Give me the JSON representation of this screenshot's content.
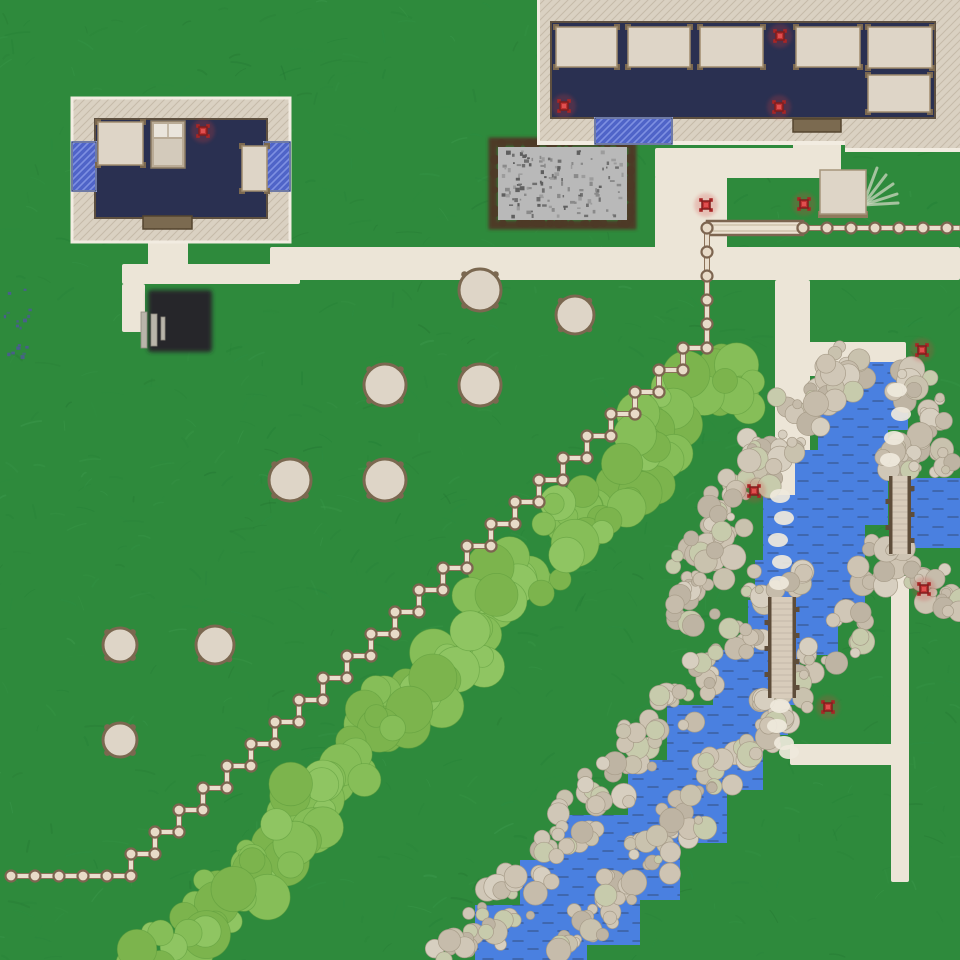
{
  "meta": {
    "width": 960,
    "height": 960
  },
  "palette": {
    "grass_base": "#2e8a3c",
    "grass_strokes": [
      "#27813a",
      "#3a9a4c",
      "#1e7a33",
      "#45a357",
      "#2a8f44",
      "#216f2f"
    ],
    "path_fill": "#ece5d7",
    "water_fill": "#4a80e0",
    "water_wave": "#3b5f9f",
    "wall_base": "#dad1c2",
    "wall_hatch_line": "#c6bba9",
    "wall_edge_light": "#f2ece1",
    "wall_border_dark": "#5e5040",
    "floor_navy": "#2a3051",
    "window_base": "#4f64c8",
    "window_stripe": "#7e90e2",
    "window_edge": "#b9c4ef",
    "door_fill": "#7b6a50",
    "door_edge": "#54452f",
    "table_fill": "#ded5c7",
    "table_edge": "#a08c6e",
    "table_leg": "#7b6850",
    "bed_frame": "#b9ab96",
    "bed_pillow": "#eae5dc",
    "bed_blanket": "#d3cabb",
    "marker_red": "#c13232",
    "marker_dark": "#801d1d",
    "marker_glow": "#d23c3c",
    "fence_rail": "#e9decd",
    "fence_rail_edge": "#8a7158",
    "fence_post": "#e8dbc8",
    "fence_post_edge": "#7d6550",
    "gate_fill": "#ece2d2",
    "bridge_deck": "#d8ccbb",
    "bridge_rail": "#5e4d3a",
    "pit_fill": "#b9b9b9",
    "pit_border": "#4e3a27",
    "pit_speckles": [
      "#8a8a8a",
      "#6f6f6f",
      "#9c9c9c",
      "#5f5f5f"
    ],
    "pad_fill": "#26262a",
    "pad_bar": "#b9b5aa",
    "pebble_palette": [
      "#cec4b3",
      "#c6bcab",
      "#d7cfc0",
      "#beb4a3",
      "#d0c7b7",
      "#c9c2ae",
      "#c7cbac"
    ],
    "pebble_edge": "#a89d8a",
    "bush_palette": [
      "#86be58",
      "#8fc562",
      "#7cb44d"
    ],
    "bush_edge": "#5d9a3c",
    "trail_fill": "#efe9dc",
    "berry_color": "#5054a0",
    "fan_color": "#cdd6c0"
  },
  "grass": {
    "seed": 7,
    "stroke_count": 850
  },
  "berry_dots": {
    "x": 2,
    "y": 286,
    "w": 30,
    "h": 70,
    "count": 18,
    "seed": 3
  },
  "paths": [
    {
      "name": "path-left-door",
      "x": 148,
      "y": 227,
      "w": 40,
      "h": 41
    },
    {
      "name": "path-left-horizontal",
      "x": 122,
      "y": 264,
      "w": 178,
      "h": 20
    },
    {
      "name": "path-left-down",
      "x": 122,
      "y": 284,
      "w": 23,
      "h": 48
    },
    {
      "name": "path-main-horizontal",
      "x": 270,
      "y": 247,
      "w": 690,
      "h": 33
    },
    {
      "name": "path-yard-vertical",
      "x": 655,
      "y": 176,
      "w": 72,
      "h": 74
    },
    {
      "name": "path-yard-horizontal",
      "x": 655,
      "y": 148,
      "w": 186,
      "h": 30
    },
    {
      "name": "path-door-stub",
      "x": 793,
      "y": 131,
      "w": 48,
      "h": 20
    },
    {
      "name": "path-river-vertical",
      "x": 775,
      "y": 280,
      "w": 35,
      "h": 285
    },
    {
      "name": "path-to-upper-bridge",
      "x": 806,
      "y": 342,
      "w": 100,
      "h": 34
    },
    {
      "name": "path-south-horizontal",
      "x": 790,
      "y": 744,
      "w": 105,
      "h": 21
    },
    {
      "name": "path-south-vertical",
      "x": 891,
      "y": 576,
      "w": 18,
      "h": 306
    }
  ],
  "stone_pit": {
    "x": 498,
    "y": 147,
    "w": 129,
    "h": 73,
    "speckle_count": 130,
    "seed": 11
  },
  "black_pad": {
    "x": 148,
    "y": 290,
    "w": 64,
    "h": 62,
    "bars": [
      {
        "x": 141,
        "y": 312,
        "w": 6,
        "h": 36
      },
      {
        "x": 151,
        "y": 314,
        "w": 6,
        "h": 32
      },
      {
        "x": 161,
        "y": 317,
        "w": 4,
        "h": 23
      }
    ]
  },
  "water_rects": [
    [
      843,
      362,
      65,
      68
    ],
    [
      818,
      402,
      70,
      68
    ],
    [
      795,
      450,
      93,
      75
    ],
    [
      897,
      478,
      63,
      70
    ],
    [
      763,
      495,
      102,
      110
    ],
    [
      755,
      560,
      83,
      95
    ],
    [
      748,
      600,
      52,
      105
    ],
    [
      713,
      650,
      75,
      85
    ],
    [
      667,
      705,
      96,
      85
    ],
    [
      628,
      760,
      99,
      83
    ],
    [
      560,
      815,
      120,
      85
    ],
    [
      520,
      860,
      120,
      85
    ],
    [
      475,
      905,
      112,
      55
    ]
  ],
  "bridges": [
    {
      "name": "bridge-upper",
      "x": 889,
      "y": 476,
      "w": 22,
      "h": 78
    },
    {
      "name": "bridge-lower",
      "x": 768,
      "y": 597,
      "w": 28,
      "h": 101
    }
  ],
  "pebbles": {
    "seed": 5,
    "clusters": [
      [
        848,
        368,
        26,
        12
      ],
      [
        820,
        392,
        30,
        14
      ],
      [
        795,
        420,
        30,
        14
      ],
      [
        770,
        448,
        32,
        15
      ],
      [
        748,
        478,
        30,
        14
      ],
      [
        728,
        508,
        30,
        14
      ],
      [
        712,
        540,
        30,
        14
      ],
      [
        700,
        572,
        28,
        13
      ],
      [
        693,
        604,
        26,
        12
      ],
      [
        912,
        385,
        20,
        9
      ],
      [
        936,
        410,
        18,
        8
      ],
      [
        928,
        440,
        16,
        7
      ],
      [
        903,
        457,
        14,
        7
      ],
      [
        940,
        462,
        13,
        6
      ],
      [
        908,
        468,
        12,
        6
      ],
      [
        872,
        562,
        24,
        11
      ],
      [
        902,
        572,
        22,
        10
      ],
      [
        933,
        585,
        22,
        10
      ],
      [
        955,
        600,
        16,
        7
      ],
      [
        762,
        585,
        18,
        8
      ],
      [
        800,
        583,
        16,
        7
      ],
      [
        737,
        638,
        26,
        12
      ],
      [
        706,
        674,
        27,
        12
      ],
      [
        673,
        710,
        27,
        12
      ],
      [
        641,
        747,
        27,
        12
      ],
      [
        609,
        784,
        27,
        12
      ],
      [
        577,
        821,
        27,
        12
      ],
      [
        545,
        858,
        27,
        12
      ],
      [
        513,
        895,
        27,
        12
      ],
      [
        481,
        930,
        26,
        11
      ],
      [
        452,
        952,
        22,
        9
      ],
      [
        845,
        630,
        25,
        11
      ],
      [
        814,
        668,
        26,
        12
      ],
      [
        782,
        705,
        26,
        12
      ],
      [
        750,
        742,
        26,
        12
      ],
      [
        718,
        780,
        26,
        12
      ],
      [
        686,
        817,
        26,
        12
      ],
      [
        654,
        854,
        26,
        12
      ],
      [
        622,
        891,
        26,
        12
      ],
      [
        591,
        927,
        24,
        10
      ],
      [
        566,
        951,
        20,
        8
      ],
      [
        772,
        712,
        16,
        7
      ],
      [
        893,
        464,
        13,
        6
      ],
      [
        897,
        556,
        14,
        6
      ]
    ]
  },
  "trail_patches": [
    [
      897,
      390
    ],
    [
      901,
      414
    ],
    [
      894,
      438
    ],
    [
      890,
      460
    ],
    [
      780,
      496
    ],
    [
      784,
      518
    ],
    [
      778,
      540
    ],
    [
      782,
      562
    ],
    [
      779,
      583
    ],
    [
      780,
      706
    ],
    [
      777,
      726
    ],
    [
      784,
      743
    ],
    [
      789,
      752
    ]
  ],
  "bushes": {
    "seed": 9,
    "clusters": [
      [
        725,
        378,
        26,
        6
      ],
      [
        745,
        395,
        18,
        4
      ],
      [
        700,
        398,
        34,
        8
      ],
      [
        668,
        428,
        34,
        8
      ],
      [
        637,
        460,
        34,
        8
      ],
      [
        607,
        492,
        34,
        8
      ],
      [
        577,
        524,
        34,
        8
      ],
      [
        547,
        556,
        34,
        8
      ],
      [
        517,
        588,
        34,
        8
      ],
      [
        487,
        620,
        34,
        8
      ],
      [
        457,
        652,
        34,
        8
      ],
      [
        427,
        684,
        34,
        8
      ],
      [
        397,
        716,
        34,
        8
      ],
      [
        367,
        748,
        34,
        8
      ],
      [
        337,
        780,
        34,
        8
      ],
      [
        307,
        812,
        34,
        8
      ],
      [
        277,
        844,
        34,
        8
      ],
      [
        247,
        876,
        34,
        8
      ],
      [
        217,
        906,
        32,
        7
      ],
      [
        187,
        932,
        30,
        7
      ],
      [
        158,
        952,
        26,
        6
      ]
    ]
  },
  "round_tables": [
    [
      480,
      290,
      21
    ],
    [
      575,
      315,
      19
    ],
    [
      385,
      385,
      21
    ],
    [
      480,
      385,
      21
    ],
    [
      290,
      480,
      21
    ],
    [
      385,
      480,
      21
    ],
    [
      120,
      645,
      17
    ],
    [
      215,
      645,
      19
    ],
    [
      120,
      740,
      17
    ]
  ],
  "fence": {
    "top_run": {
      "x1": 803,
      "x2": 960,
      "y": 228,
      "post_spacing": 24
    },
    "gate": {
      "x": 707,
      "x2": 803,
      "y": 228,
      "h": 14
    },
    "main": {
      "start": [
        707,
        228
      ],
      "corner": [
        707,
        348
      ],
      "steps": 24,
      "dx": -24,
      "dy": 22,
      "tail_x_end": 11
    }
  },
  "left_building": {
    "outer": {
      "x": 72,
      "y": 98,
      "w": 218,
      "h": 144
    },
    "floor": {
      "x": 95,
      "y": 119,
      "w": 172,
      "h": 99
    },
    "windows": [
      {
        "x": 72,
        "y": 142,
        "w": 24,
        "h": 49
      },
      {
        "x": 264,
        "y": 142,
        "w": 26,
        "h": 49
      }
    ],
    "door": {
      "x": 143,
      "y": 216,
      "w": 49,
      "h": 13
    },
    "furniture": [
      {
        "type": "table",
        "x": 98,
        "y": 122,
        "w": 45,
        "h": 43
      },
      {
        "type": "bed",
        "x": 151,
        "y": 121,
        "w": 34,
        "h": 47
      },
      {
        "type": "table",
        "x": 242,
        "y": 146,
        "w": 25,
        "h": 45
      }
    ]
  },
  "big_building": {
    "outer": {
      "x": 537,
      "y": 0,
      "w": 423,
      "h": 145
    },
    "outer2": {
      "x": 845,
      "y": 0,
      "w": 115,
      "h": 152
    },
    "floor": {
      "x": 551,
      "y": 22,
      "w": 384,
      "h": 96
    },
    "windows": [
      {
        "x": 595,
        "y": 118,
        "w": 77,
        "h": 26
      }
    ],
    "door": {
      "x": 793,
      "y": 119,
      "w": 48,
      "h": 13
    },
    "furniture": [
      {
        "type": "table",
        "x": 556,
        "y": 27,
        "w": 61,
        "h": 40
      },
      {
        "type": "table",
        "x": 628,
        "y": 27,
        "w": 62,
        "h": 40
      },
      {
        "type": "table",
        "x": 700,
        "y": 27,
        "w": 63,
        "h": 40
      },
      {
        "type": "table",
        "x": 796,
        "y": 27,
        "w": 64,
        "h": 40
      },
      {
        "type": "table",
        "x": 868,
        "y": 27,
        "w": 64,
        "h": 41
      },
      {
        "type": "table",
        "x": 868,
        "y": 75,
        "w": 62,
        "h": 37
      }
    ]
  },
  "small_table": {
    "x": 820,
    "y": 170,
    "w": 46,
    "h": 44
  },
  "fan_decal": {
    "base": [
      863,
      205
    ],
    "tips": [
      [
        877,
        168
      ],
      [
        886,
        175
      ],
      [
        893,
        184
      ],
      [
        897,
        194
      ],
      [
        898,
        203
      ]
    ]
  },
  "markers": [
    [
      203,
      131
    ],
    [
      564,
      106
    ],
    [
      780,
      36
    ],
    [
      779,
      107
    ],
    [
      706,
      205
    ],
    [
      804,
      204
    ],
    [
      922,
      350
    ],
    [
      754,
      491
    ],
    [
      924,
      589
    ],
    [
      828,
      707
    ]
  ]
}
